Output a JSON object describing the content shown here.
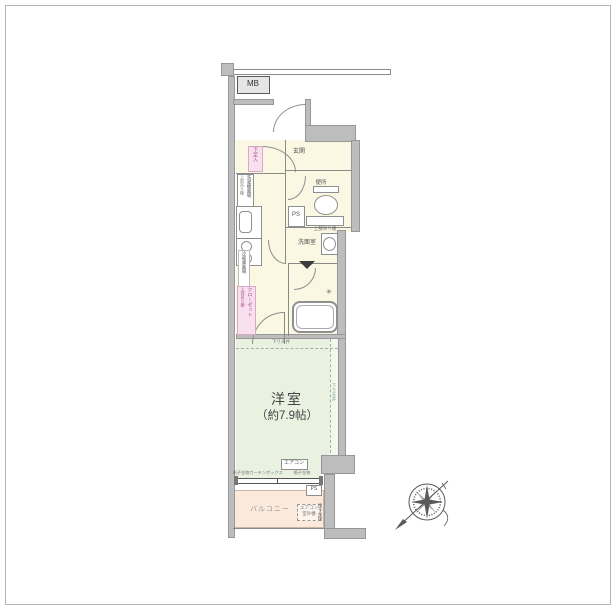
{
  "plan": {
    "mb": "MB",
    "entrance": "玄関",
    "shoe_box": "下足入",
    "laundry": "洗濯機置場",
    "laundry_shelf": "上部吊り棚",
    "ps_upper": "PS",
    "toilet": "便所",
    "toilet_shelf": "上部吊り棚",
    "washroom": "洗面室",
    "fridge": "冷蔵庫置場",
    "closet": "クローゼット",
    "closet_shelf": "上部吊り棚",
    "dropped_ceiling_top": "下り天井",
    "dropped_ceiling_side": "下り天井",
    "room_name": "洋室",
    "room_size": "（約7.9帖）",
    "aircon": "エアコン",
    "window_left": "格子金物",
    "curtain_box": "カーテンボックス",
    "window_right": "格子金物",
    "ps_lower": "PS",
    "balcony": "バルコニー",
    "ac_outdoor_line1": "エアコン",
    "ac_outdoor_line2": "室外機",
    "laundry_pole": "物干金物"
  },
  "icons": {
    "faucet": "✳"
  },
  "colors": {
    "wall": "#bdbdbd",
    "hall_floor": "#faf7e3",
    "room_floor": "#e9f2e1",
    "balcony_floor": "#fbe9dc",
    "label_pink_bg": "#f9e0ee",
    "label_pink_text": "#a8538d",
    "line": "#8a8a8a"
  }
}
